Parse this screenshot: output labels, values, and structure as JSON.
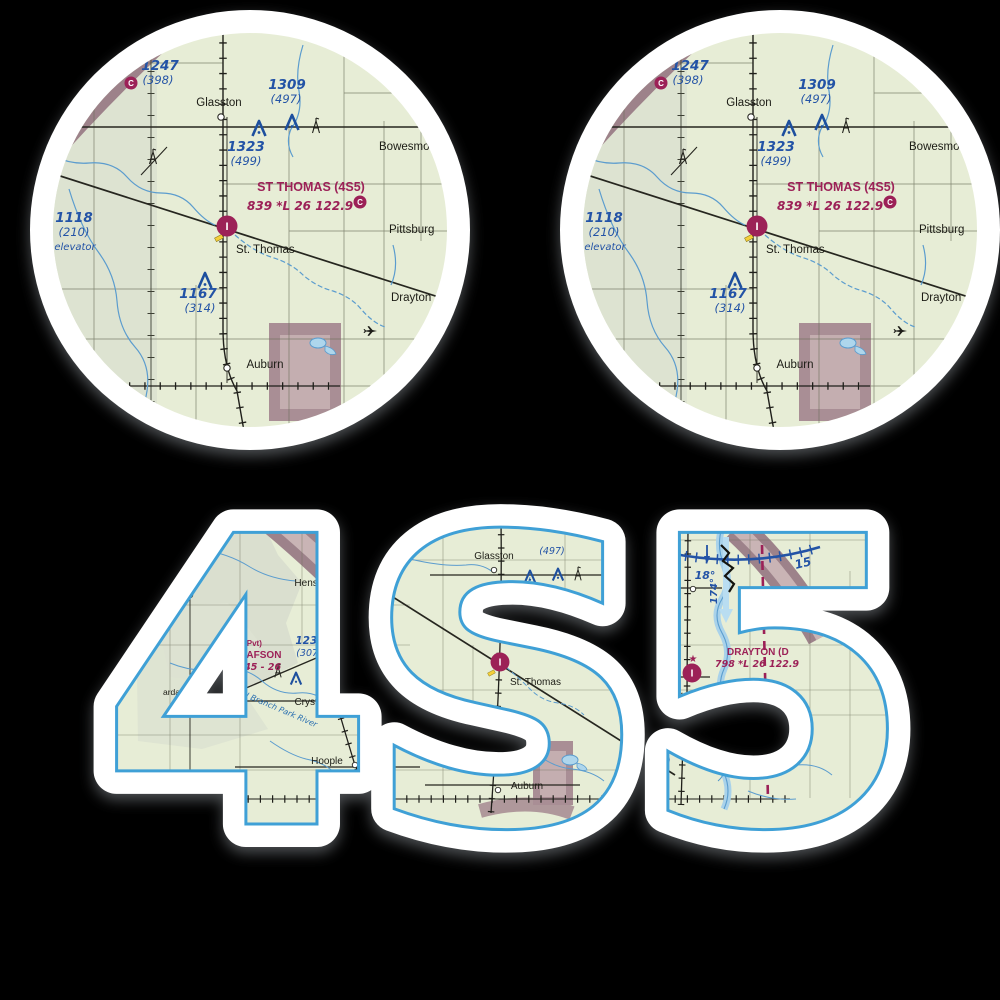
{
  "sticker_text": "4S5",
  "symbols": {
    "airport_letter": "I",
    "ctaf_letter": "C",
    "restricted_letter": "R",
    "beacon_star": "★"
  },
  "colors": {
    "background": "#000000",
    "sticker_white": "#ffffff",
    "map_green": "#e7edd6",
    "chart_blue": "#2353a6",
    "chart_maroon": "#9c2157",
    "window_outline_blue": "#3fa0d6"
  },
  "circle_chart": {
    "airport_title": "ST THOMAS (4S5)",
    "airport_info": "839 *L 26 122.9",
    "frag_top": ".5",
    "frag_freq": "..8",
    "glasston": "Glasston",
    "st_thomas": "St. Thomas",
    "auburn": "Auburn",
    "bowesmont": "Bowesmont",
    "pittsburg": "Pittsburg",
    "drayton": "Drayton",
    "e1247": "1247",
    "a1247": "(398)",
    "e1309": "1309",
    "a1309": "(497)",
    "e1323": "1323",
    "a1323": "(499)",
    "e1118": "1118",
    "a1118": "(210)",
    "n1118": "elevator",
    "e1167": "1167",
    "a1167": "(314)"
  },
  "wide_chart": {
    "hensel": "Hensel",
    "crystal": "Crystal",
    "hoople": "Hoople",
    "glasston": "Glasston",
    "st_thomas": "St. Thomas",
    "auburn": "Auburn",
    "bowesmont": "Bowesmont",
    "pittsburg": "Pittsburg",
    "plant": "plant",
    "drayton": "Drayton",
    "robbin": "Robbin",
    "p_dgs": "dgs",
    "p_ain": "ain",
    "p_ardar": "ardar",
    "olafson_pvt": "(Pvt)",
    "olafson_name": "OLAFSON",
    "olafson_info": "1045 - 26",
    "st_thomas_title": "ST THOMAS (4S5)",
    "st_thomas_info": "839 *L 26 122.9",
    "drayton_title": "DRAYTON (D",
    "drayton_info": "798 *L 26 122.9",
    "e1235": "1235",
    "a1235": "(307)",
    "p111": "111",
    "p21": "(21",
    "peleva": "eleva",
    "e1323": "1323",
    "a1323": "(499)",
    "a497": "(497)",
    "a314": "(314)",
    "e1095": "1095",
    "a1095": "(285)",
    "e1241": "1241",
    "a1241": "(442)",
    "river_label": "N Branch Park River",
    "deg18": "18°",
    "deg174": "174°",
    "n15": "15"
  }
}
